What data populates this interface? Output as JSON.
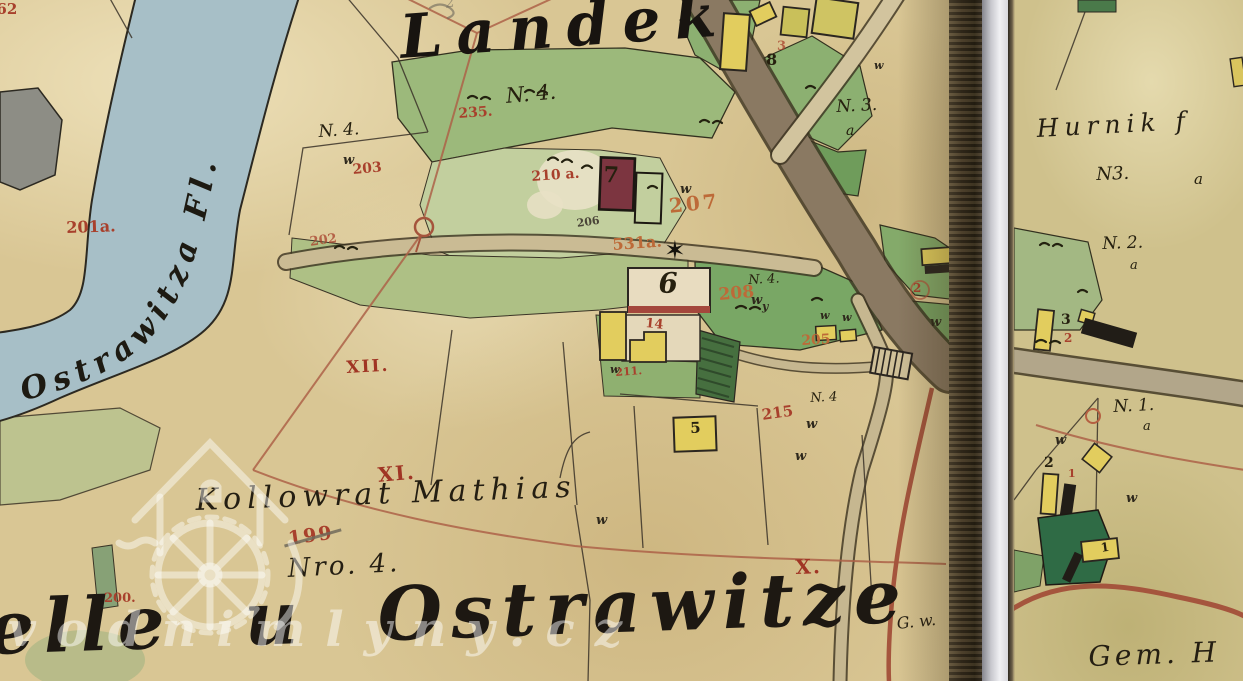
{
  "watermark": {
    "site_text": "vodnimlyny.cz"
  },
  "symbols": {
    "star": "✶",
    "meadow_mark": "w",
    "y_mark": "y"
  },
  "left_page": {
    "village_title": "Landek",
    "river_label": "Ostrawitza Fl.",
    "settlement_title_partial": "elle u Ostrawitze",
    "owner_name": "Kollowrat Mathias",
    "owner_house_no": "Nro. 4.",
    "road_label": "G. w.",
    "pencil_mark": "2",
    "numerals": {
      "xii": "XII.",
      "xi": "XI.",
      "x": "X."
    },
    "red": {
      "n262": "262",
      "n201a": "201a.",
      "n235": "235.",
      "n203": "203",
      "n202": "202",
      "n210": "210 a.",
      "n207": "207",
      "n531a": "531a.",
      "n206": "206",
      "n208": "208",
      "n205": "205",
      "n215": "215",
      "n199": "199",
      "n200": "200.",
      "n211": "211.",
      "n14": "14",
      "n3": "3",
      "n2": "2"
    },
    "black": {
      "n4_meadow": "N. 4.",
      "n4_field": "N. 4.",
      "n3_label": "N. 3.",
      "n3_a": "a",
      "n4_208": "N. 4.",
      "n4_215": "N. 4",
      "h5": "5",
      "h6": "6",
      "h7": "7",
      "h8": "8"
    }
  },
  "right_page": {
    "owner_name": "Hurnik f",
    "plots": {
      "n3": "N3.",
      "n3_a": "a",
      "n2": "N. 2.",
      "n2_a": "a",
      "n1": "N. 1.",
      "n1_a": "a"
    },
    "black": {
      "b3": "3",
      "b2": "2",
      "b1": "1"
    },
    "red": {
      "r2": "2",
      "r1": "1"
    },
    "bottom_label": "Gem. H"
  }
}
